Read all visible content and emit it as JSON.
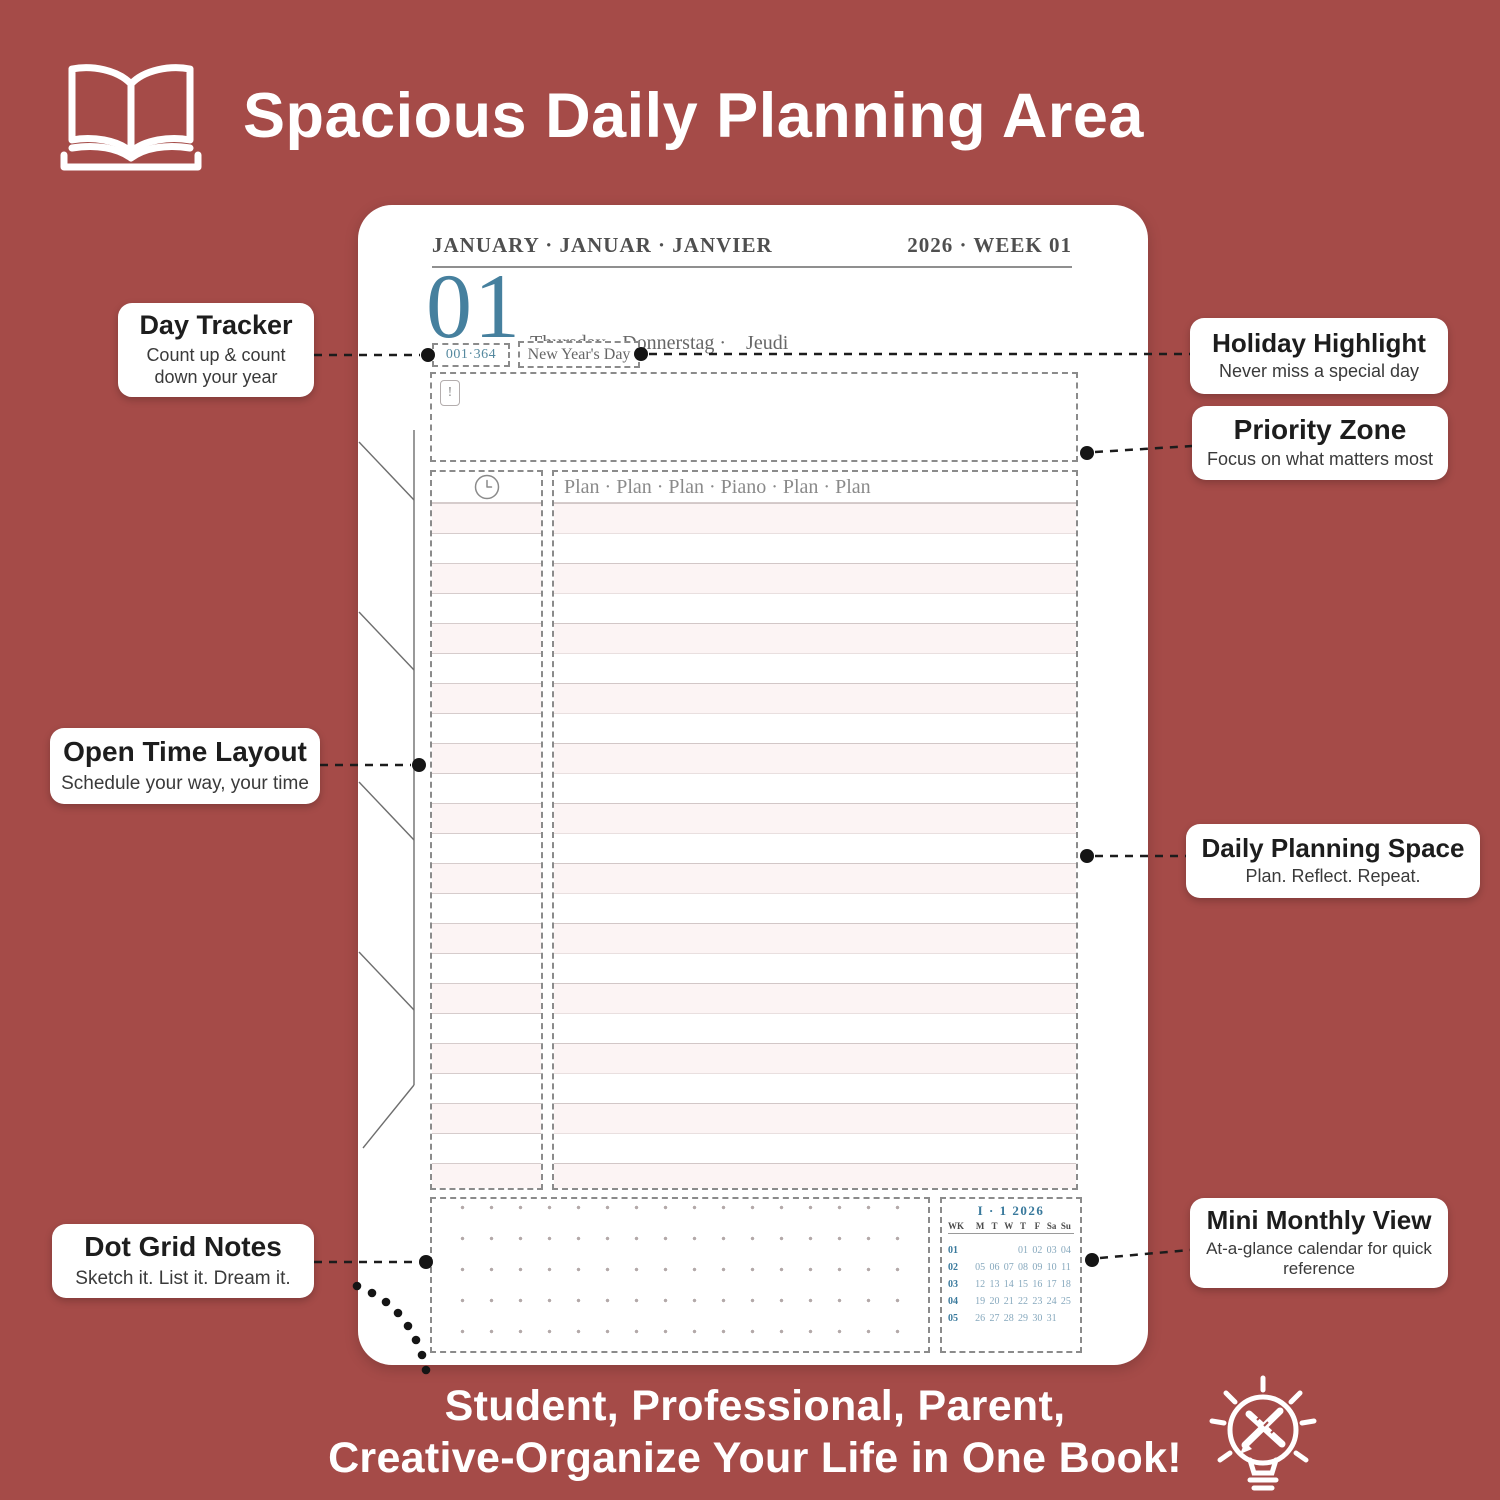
{
  "colors": {
    "background": "#a54b48",
    "accent_teal": "#46809e",
    "page_white": "#ffffff",
    "stripe_pink": "#fcf4f4",
    "callout_text": "#1d1d1d"
  },
  "header": {
    "title": "Spacious Daily Planning Area",
    "icon": "open-book-icon"
  },
  "planner": {
    "month_line": "JANUARY · JANUAR · JANVIER",
    "year_week": "2026 · WEEK 01",
    "day_number": "01",
    "day_names_line1": "Thursday · Donnerstag ·    Jeudi",
    "day_names_line2": "Giovedì  ·    Jueves    · Donderdag",
    "day_tracker": "001·364",
    "holiday": "New Year's Day",
    "priority_marker": "!",
    "plan_header": "Plan · Plan · Plan · Piano · Plan · Plan",
    "mini_calendar": {
      "title": "I · 1  2026",
      "columns": [
        "WK",
        "M",
        "T",
        "W",
        "T",
        "F",
        "Sa",
        "Su"
      ],
      "rows": [
        [
          "01",
          "",
          "",
          "",
          "01",
          "02",
          "03",
          "04"
        ],
        [
          "02",
          "05",
          "06",
          "07",
          "08",
          "09",
          "10",
          "11"
        ],
        [
          "03",
          "12",
          "13",
          "14",
          "15",
          "16",
          "17",
          "18"
        ],
        [
          "04",
          "19",
          "20",
          "21",
          "22",
          "23",
          "24",
          "25"
        ],
        [
          "05",
          "26",
          "27",
          "28",
          "29",
          "30",
          "31",
          ""
        ]
      ]
    }
  },
  "callouts": [
    {
      "id": "day-tracker",
      "title": "Day Tracker",
      "subtitle": "Count up & count down your year"
    },
    {
      "id": "open-time-layout",
      "title": "Open Time Layout",
      "subtitle": "Schedule your way, your time"
    },
    {
      "id": "dot-grid-notes",
      "title": "Dot Grid Notes",
      "subtitle": "Sketch it. List it. Dream it."
    },
    {
      "id": "holiday-highlight",
      "title": "Holiday Highlight",
      "subtitle": "Never miss a special day"
    },
    {
      "id": "priority-zone",
      "title": "Priority Zone",
      "subtitle": "Focus on what matters most"
    },
    {
      "id": "daily-planning-space",
      "title": "Daily Planning Space",
      "subtitle": "Plan. Reflect. Repeat."
    },
    {
      "id": "mini-monthly-view",
      "title": "Mini Monthly View",
      "subtitle": "At-a-glance calendar for quick reference"
    }
  ],
  "footer": {
    "line1": "Student, Professional, Parent,",
    "line2": "Creative-Organize Your Life in One Book!",
    "icon": "lightbulb-pencil-icon"
  }
}
